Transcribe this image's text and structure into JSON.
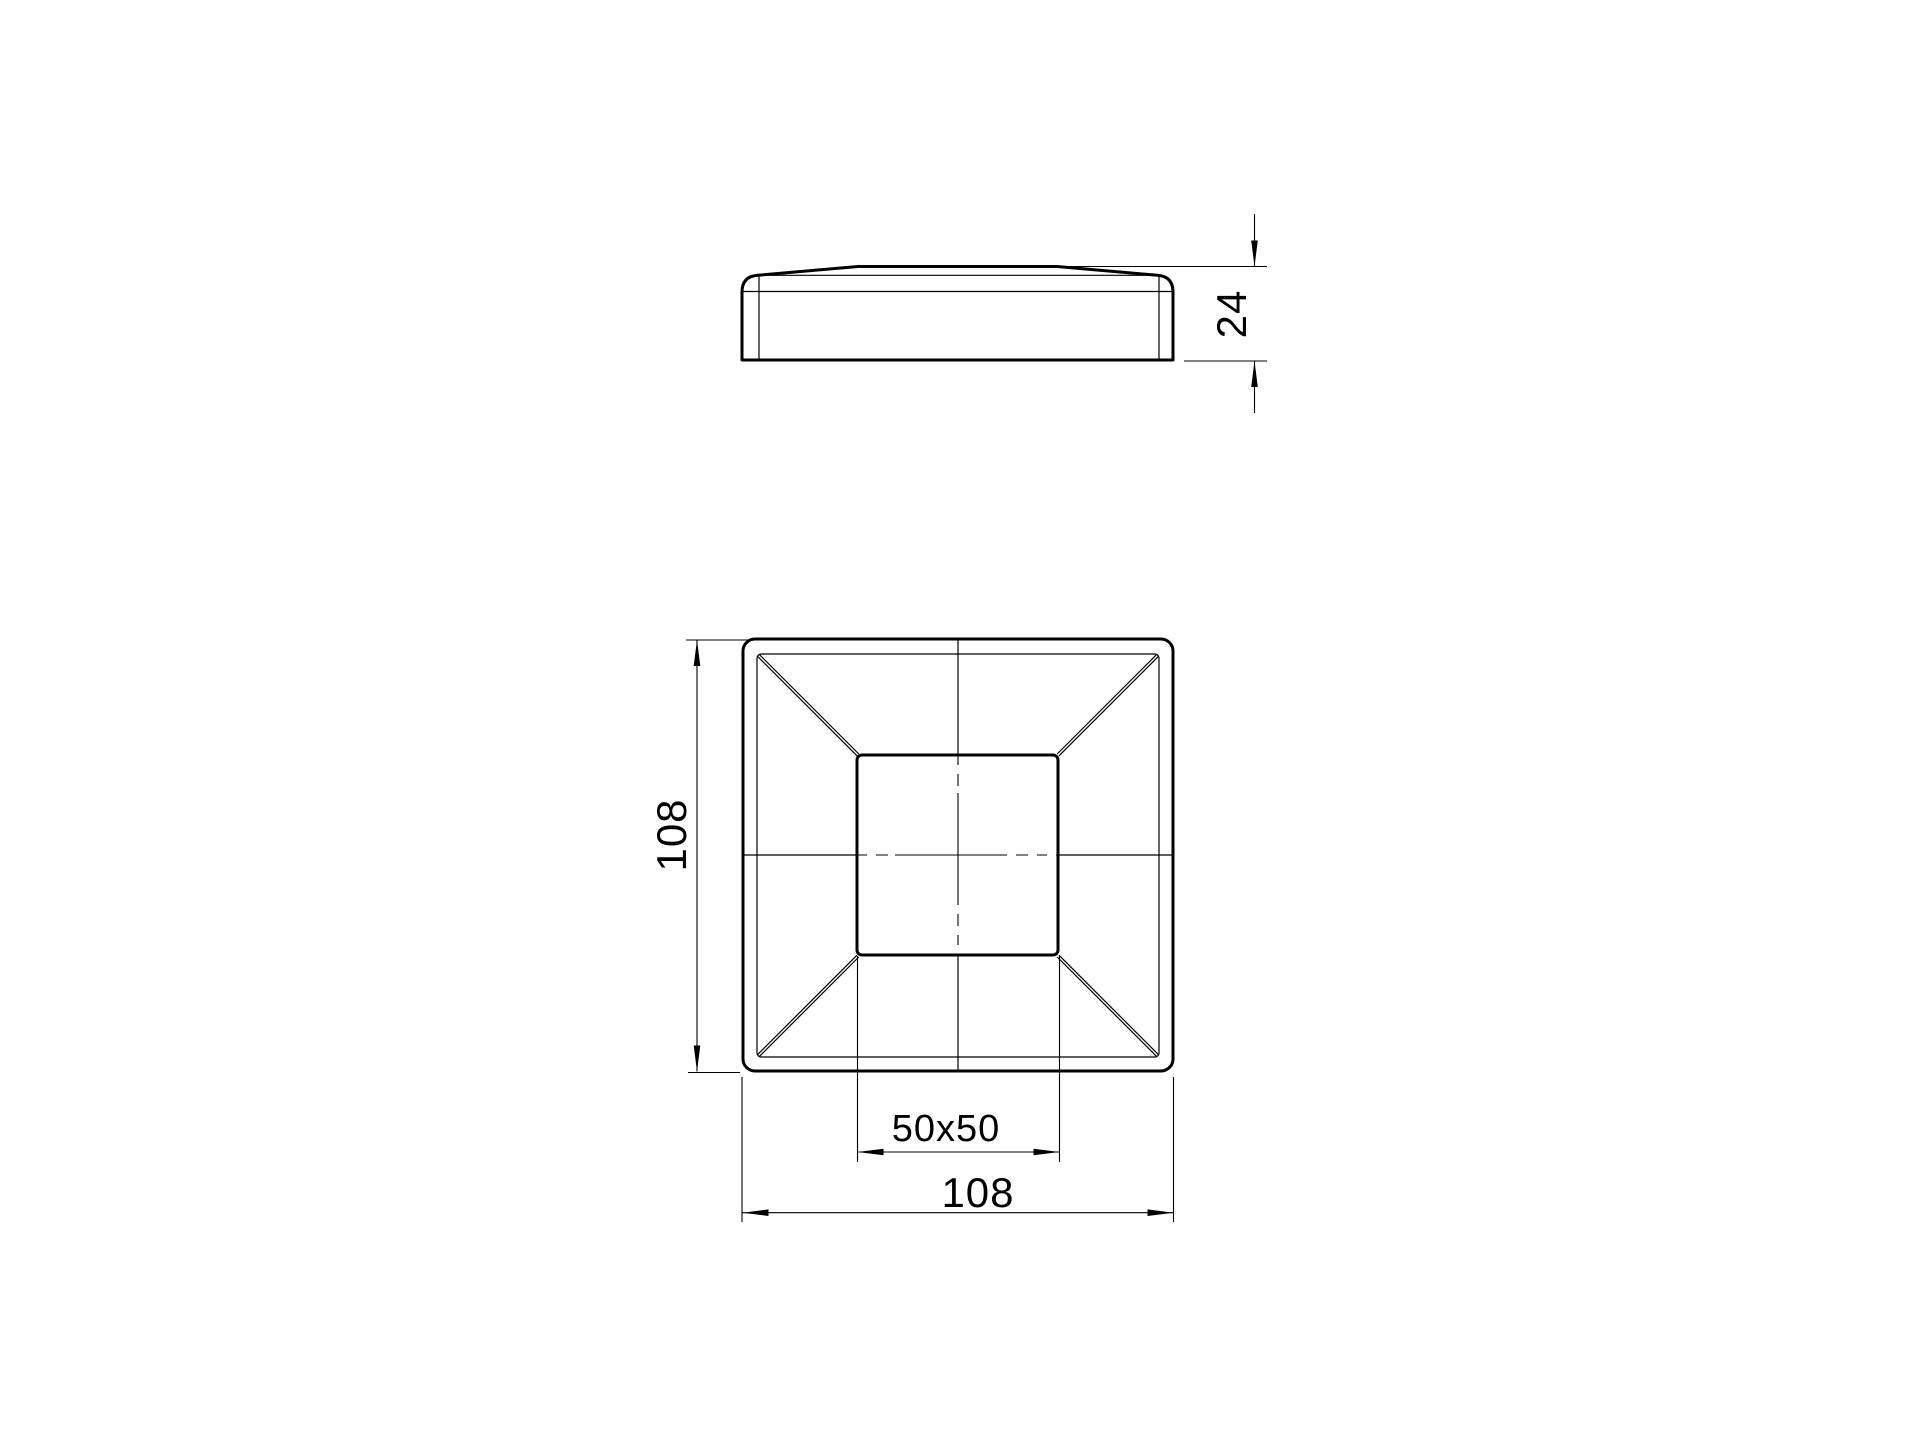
{
  "drawing": {
    "background_color": "#ffffff",
    "line_color": "#000000",
    "dimensions": {
      "cap_height": "24",
      "overall_size_vertical": "108",
      "post_opening": "50x50",
      "overall_size_horizontal": "108"
    }
  }
}
